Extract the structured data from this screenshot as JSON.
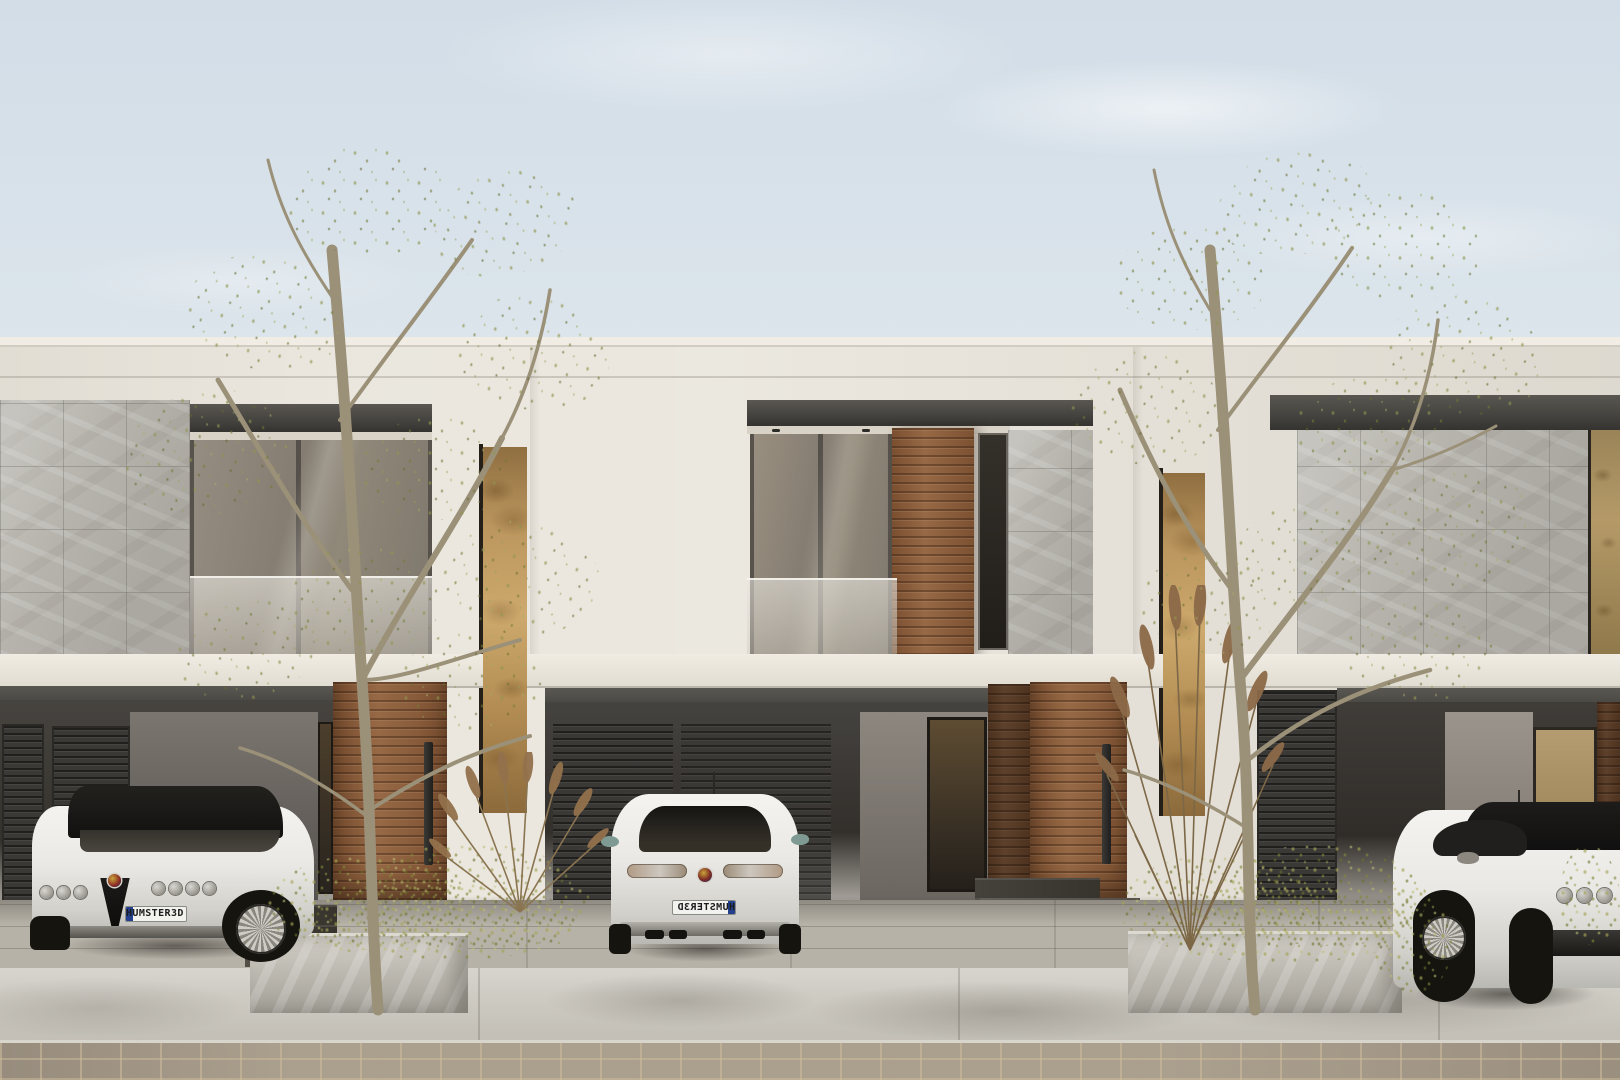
{
  "scene": {
    "type": "photorealistic 3D exterior render",
    "description": "Street elevation of a modern two-storey townhouse row with three units. Warm white stucco facades, grey marble tile cladding, horizontal timber slat panels and doors, full-height amber glass slot windows, recessed balconies with glass balustrades, carports with dark louvered panels, three white sports coupes parked in front, two young trees in concrete planters, shrubs and dry plume grasses, concrete sidewalk and cobblestone street under a pale hazy sky.",
    "sky": {
      "top_color": "#d2dde7",
      "horizon_color": "#ece9e1",
      "clouds": "soft white wisps"
    },
    "building": {
      "storeys": 2,
      "units": 3,
      "facade_color": "#e9e5dc",
      "stone_tile_color": "#b6b3ac",
      "timber_color": "#8e5f3c",
      "amber_glass_color": "#c2a05f",
      "recess_color": "#3d3b37",
      "houses": [
        {
          "id": "left",
          "upper_floor": "stone tile cladding, recessed balcony with framed glass sliding doors and glass balustrade",
          "ground_floor": "carport with louvered panels, timber entry door with long black pull handle, narrow dark slot window",
          "feature": "full-height amber glass slot window"
        },
        {
          "id": "middle",
          "upper_floor": "recessed balcony with glass doors, timber slat panel, narrow dark window, stone tile cladding",
          "ground_floor": "carport, lit entry porch with narrow amber window, timber entry door with black pull handle, dark stone entry steps",
          "feature": "full-height amber glass slot window"
        },
        {
          "id": "right",
          "upper_floor": "stone tile cladding, amber patterned-glass recess at frame edge",
          "ground_floor": "louvered panel, carport, tan rear door, timber slat strip"
        }
      ]
    },
    "cars": [
      {
        "position": "left",
        "model": "white sports coupe",
        "view": "front three-quarter",
        "plate": "HUMSTER3D",
        "plate_style": "white EU plate with blue band"
      },
      {
        "position": "middle",
        "model": "white sports coupe",
        "view": "rear",
        "plate": "HUMSTER3D",
        "plate_note": "seen mirrored"
      },
      {
        "position": "right",
        "model": "white sports coupe",
        "view": "front three-quarter, cropped by frame edge",
        "plate": ""
      }
    ],
    "vegetation": {
      "trees": "two sparse young birch-like trees in raised concrete planters",
      "shrubs": "rounded olive-green shrubs",
      "grasses": "dry brown ornamental plume grasses",
      "leaf_color": "#8f9448",
      "trunk_color": "#9b9078"
    },
    "ground": {
      "driveway_color": "#b7b2a8",
      "sidewalk_color": "#cecbc3",
      "street": "cobblestone",
      "street_color": "#ab9f8e",
      "steps_color": "#37342d"
    }
  }
}
